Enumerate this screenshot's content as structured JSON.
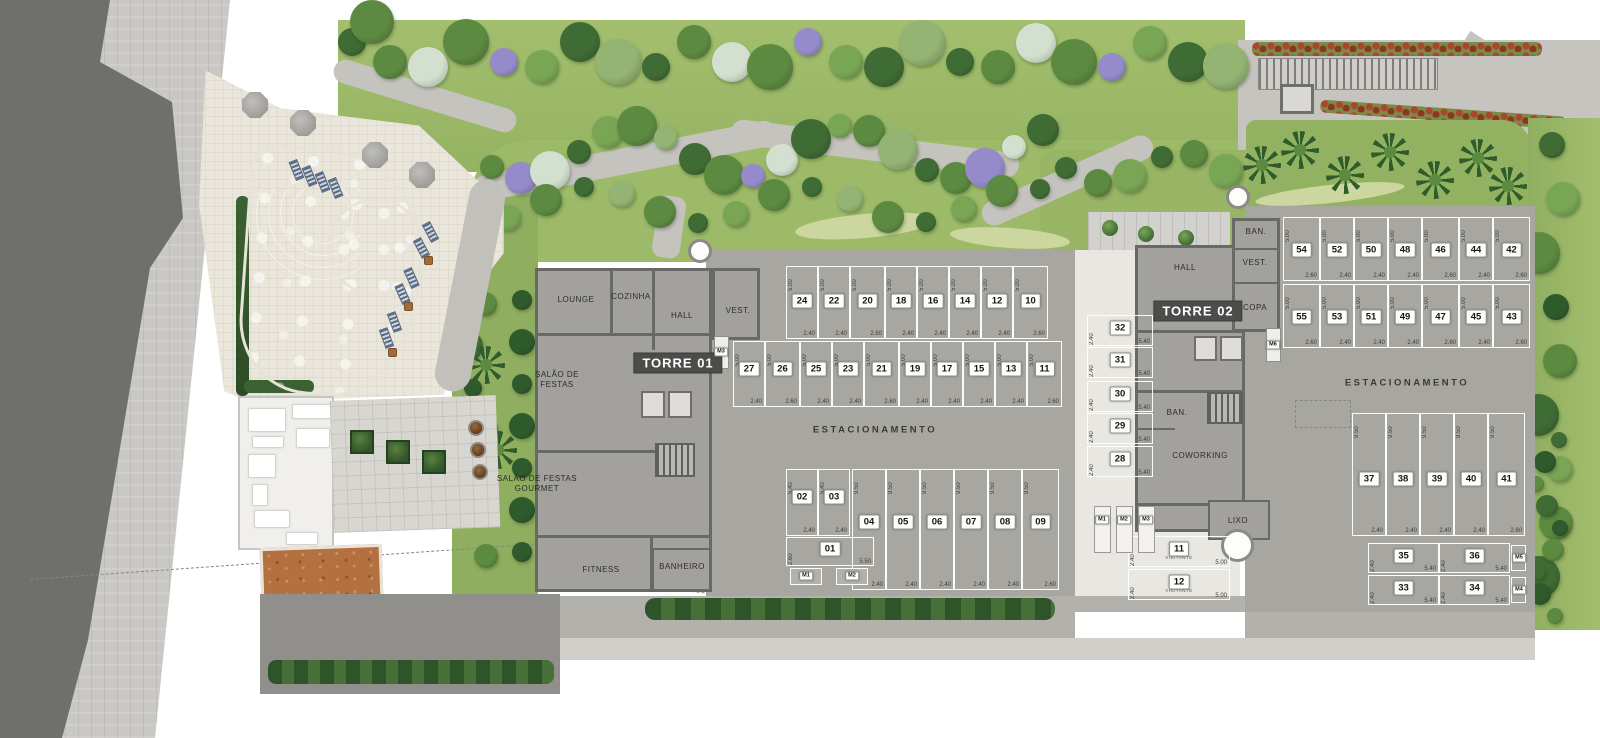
{
  "plan": {
    "towers": {
      "t1": {
        "chip": "TORRE 01",
        "rooms": {
          "lounge": "LOUNGE",
          "cozinha": "COZINHA",
          "hall": "HALL",
          "vest": "VEST.",
          "salao_festas": "SALÃO DE FESTAS",
          "salao_gourmet": "SALÃO DE FESTAS GOURMET",
          "fitness": "FITNESS",
          "banheiro": "BANHEIRO"
        }
      },
      "t2": {
        "chip": "TORRE 02",
        "rooms": {
          "hall": "HALL",
          "ban": "BAN.",
          "vest": "VEST.",
          "copa": "COPA",
          "ban2": "BAN.",
          "coworking": "COWORKING",
          "lixo": "LIXO"
        }
      }
    },
    "labels": {
      "estacionamento": "ESTACIONAMENTO",
      "visitante": "VISITANTE"
    },
    "stalls": {
      "center_top": {
        "nums": [
          "24",
          "22",
          "20",
          "18",
          "16",
          "14",
          "12",
          "10"
        ],
        "widths": [
          "2.40",
          "2.40",
          "2.60",
          "2.40",
          "2.40",
          "2.40",
          "2.40",
          "2.60"
        ],
        "depth": "5.00"
      },
      "center_mid": {
        "nums": [
          "27",
          "26",
          "25",
          "23",
          "21",
          "19",
          "17",
          "15",
          "13",
          "11"
        ],
        "widths": [
          "2.40",
          "2.60",
          "2.40",
          "2.40",
          "2.60",
          "2.40",
          "2.40",
          "2.40",
          "2.40",
          "2.60"
        ],
        "depth": "5.00"
      },
      "center_short": {
        "nums": [
          "02",
          "03"
        ],
        "widths": [
          "2.40",
          "2.40"
        ],
        "depth": "5.40"
      },
      "center_long": {
        "nums": [
          "04",
          "05",
          "06",
          "07",
          "08",
          "09"
        ],
        "widths": [
          "2.40",
          "2.40",
          "2.40",
          "2.40",
          "2.40",
          "2.60"
        ],
        "depth": "9.50"
      },
      "right_top": {
        "nums": [
          "54",
          "52",
          "50",
          "48",
          "46",
          "44",
          "42"
        ],
        "widths": [
          "2.60",
          "2.40",
          "2.40",
          "2.40",
          "2.60",
          "2.40",
          "2.60"
        ],
        "depth": "5.00"
      },
      "right_mid": {
        "nums": [
          "55",
          "53",
          "51",
          "49",
          "47",
          "45",
          "43"
        ],
        "widths": [
          "2.60",
          "2.40",
          "2.40",
          "2.40",
          "2.60",
          "2.40",
          "2.60"
        ],
        "depth": "5.00"
      },
      "right_long": {
        "nums": [
          "37",
          "38",
          "39",
          "40",
          "41"
        ],
        "widths": [
          "2.40",
          "2.40",
          "2.40",
          "2.40",
          "2.60"
        ],
        "depth": "9.50"
      },
      "visitor_stack": {
        "nums": [
          "32",
          "31",
          "30",
          "29",
          "28"
        ],
        "len": "5.40",
        "side": "2.40"
      },
      "right_h1": {
        "nums": [
          "35",
          "36"
        ],
        "len": "5.40",
        "side": "2.40"
      },
      "right_h2": {
        "nums": [
          "33",
          "34"
        ],
        "len": "5.40",
        "side": "2.40"
      },
      "spot01": {
        "nums": [
          "01"
        ],
        "len": "5.50",
        "side": "2.60"
      },
      "visitor_spots": {
        "nums": [
          "11",
          "12"
        ],
        "sub": "VISITANTE",
        "len": "5.00",
        "side": "2.40"
      }
    },
    "moto": {
      "center": [
        "M1",
        "M2"
      ],
      "visitor": [
        "M1",
        "M2",
        "M3"
      ],
      "right": [
        "M5",
        "M4"
      ],
      "tower1": "M3",
      "tower2": "M6"
    }
  },
  "colors": {
    "road": "#6f706e",
    "sidewalk": "#c9c8c4",
    "lawn": "#9cba68",
    "path": "#c5c3be",
    "slab": "#a8a6a1",
    "building_floor": "#a3a19d",
    "wall": "#686866",
    "visitor_area": "#e9e7e2",
    "pool_water": "#b6cdd3",
    "deck": "#eae6db",
    "court": "#b4703e",
    "red_hedge": "#ab452c",
    "purple_tree": "#958bca"
  }
}
